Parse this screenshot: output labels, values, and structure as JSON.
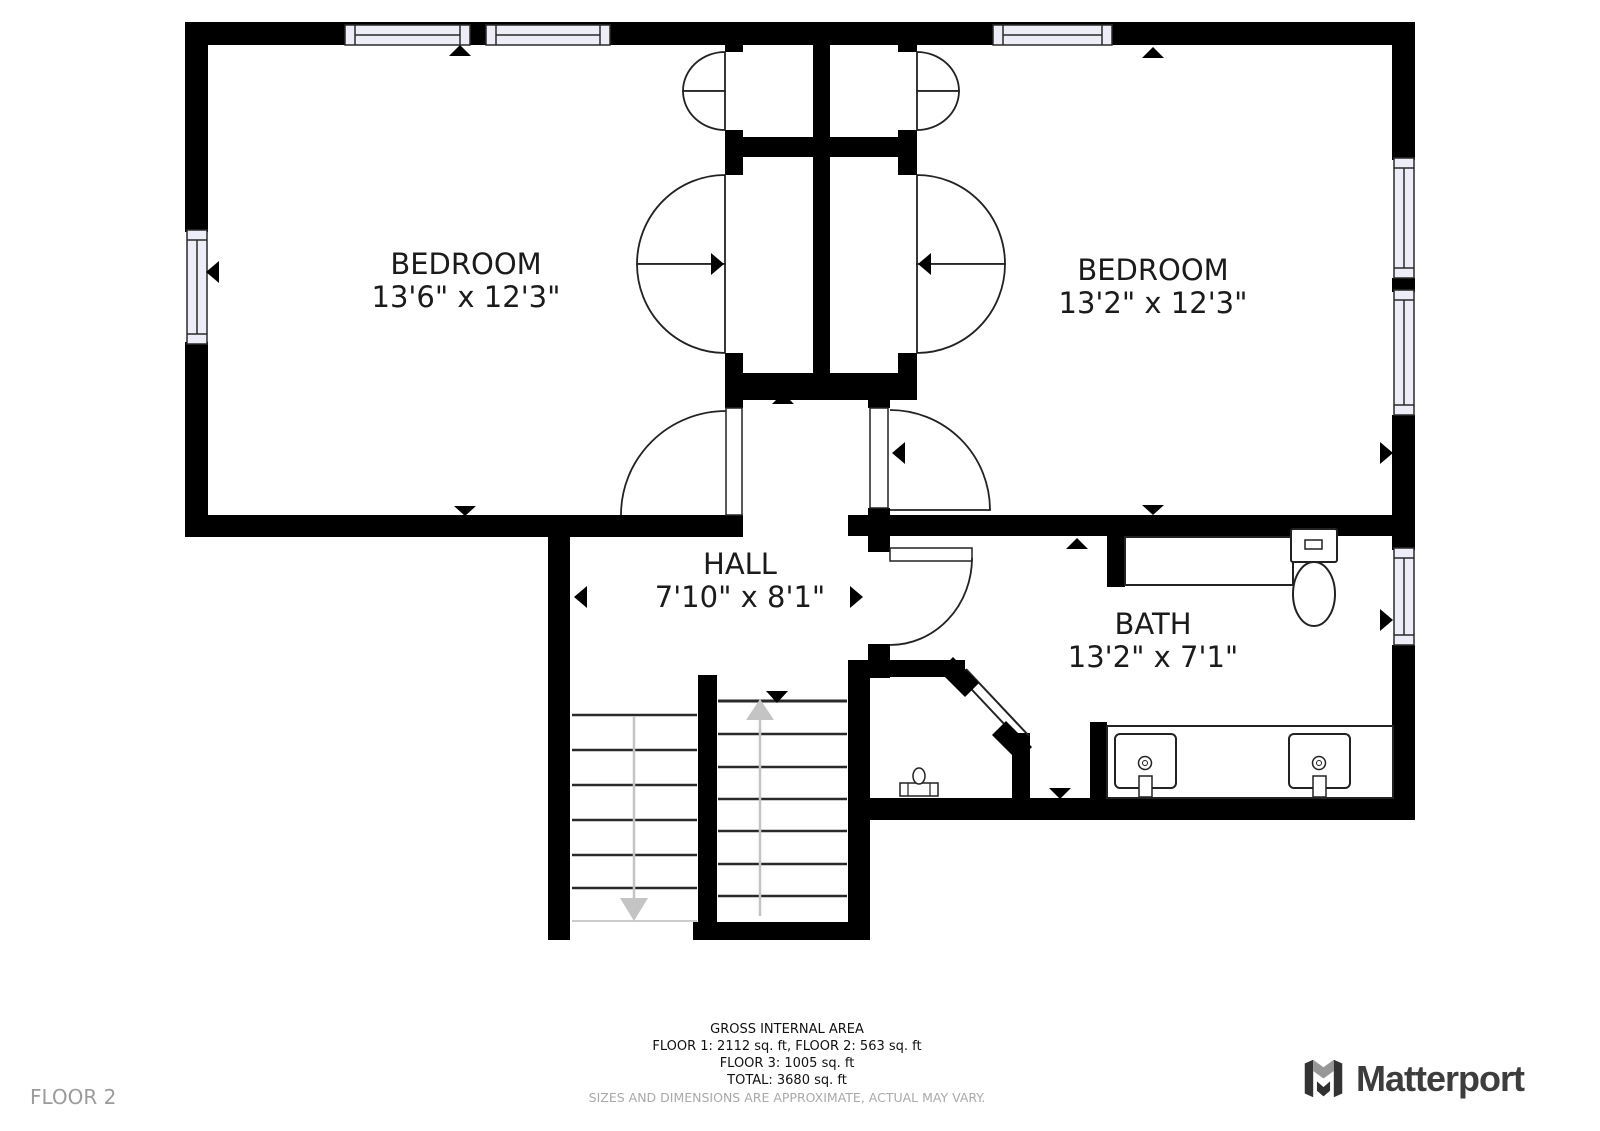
{
  "floor_label": "FLOOR 2",
  "brand": {
    "name": "Matterport"
  },
  "rooms": [
    {
      "name": "BEDROOM",
      "dims": "13'6\" x 12'3\""
    },
    {
      "name": "BEDROOM",
      "dims": "13'2\" x 12'3\""
    },
    {
      "name": "HALL",
      "dims": "7'10\" x 8'1\""
    },
    {
      "name": "BATH",
      "dims": "13'2\" x 7'1\""
    }
  ],
  "footer": {
    "title": "GROSS INTERNAL AREA",
    "line1": "FLOOR 1: 2112 sq. ft, FLOOR 2: 563 sq. ft",
    "line2": "FLOOR 3: 1005 sq. ft",
    "line3": "TOTAL: 3680 sq. ft",
    "disclaimer": "SIZES AND DIMENSIONS ARE APPROXIMATE, ACTUAL MAY VARY."
  },
  "colors": {
    "wall": "#000000",
    "window_fill": "#EDEDF7",
    "stair_arrow": "#c4c4c4",
    "brand_dark": "#3d3d3d",
    "muted_text": "#9b9b9b"
  }
}
